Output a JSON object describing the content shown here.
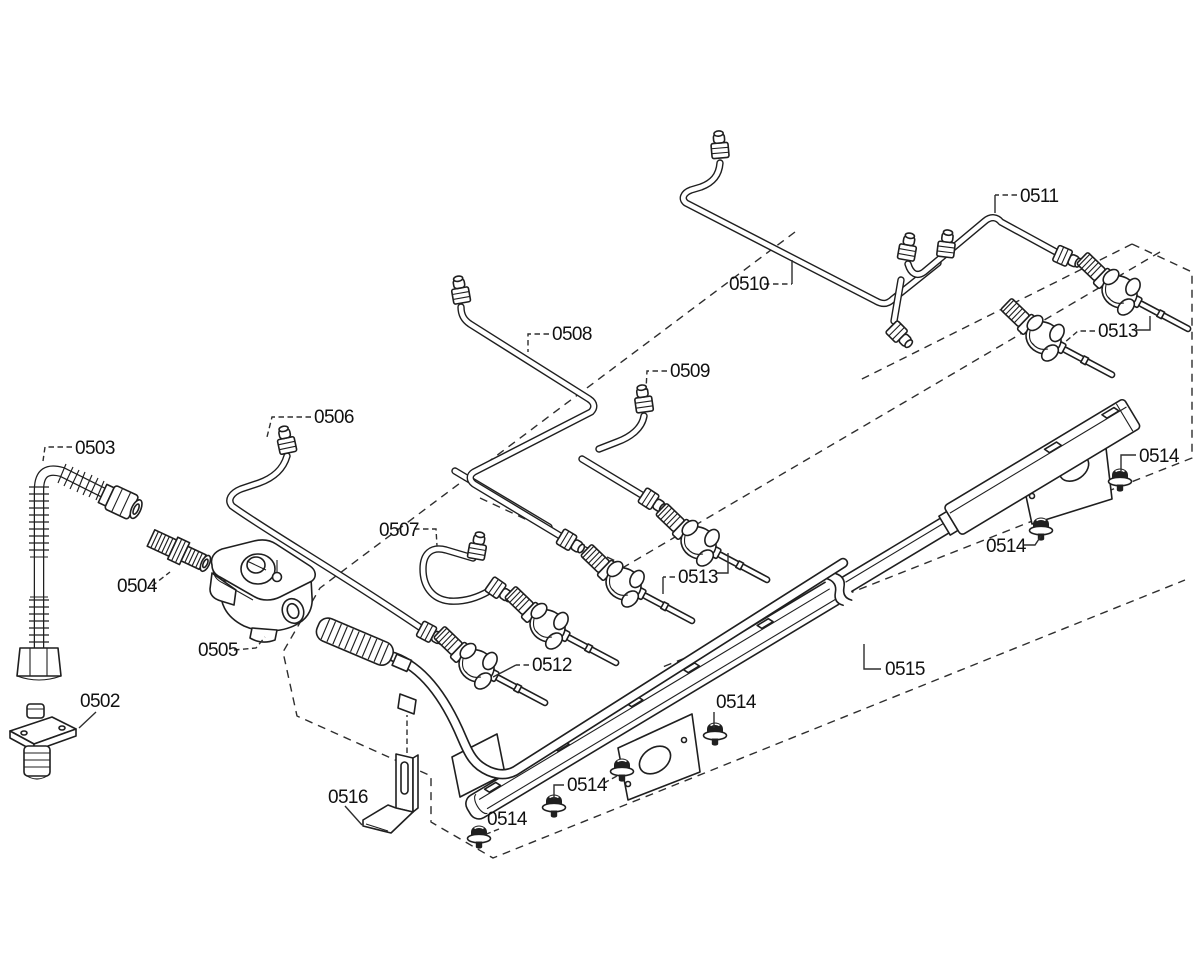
{
  "canvas": {
    "width": 1200,
    "height": 969,
    "background": "#ffffff",
    "line_color": "#1f1f1f",
    "label_color": "#111111"
  },
  "diagram": {
    "labels": [
      {
        "id": "0502",
        "text": "0502",
        "x": 80,
        "y": 707
      },
      {
        "id": "0503",
        "text": "0503",
        "x": 75,
        "y": 454
      },
      {
        "id": "0504",
        "text": "0504",
        "x": 117,
        "y": 592
      },
      {
        "id": "0505",
        "text": "0505",
        "x": 198,
        "y": 656
      },
      {
        "id": "0506",
        "text": "0506",
        "x": 314,
        "y": 423
      },
      {
        "id": "0507",
        "text": "0507",
        "x": 379,
        "y": 536
      },
      {
        "id": "0508",
        "text": "0508",
        "x": 552,
        "y": 340
      },
      {
        "id": "0509",
        "text": "0509",
        "x": 670,
        "y": 377
      },
      {
        "id": "0510",
        "text": "0510",
        "x": 729,
        "y": 290
      },
      {
        "id": "0511",
        "text": "0511",
        "x": 1020,
        "y": 202
      },
      {
        "id": "0512",
        "text": "0512",
        "x": 532,
        "y": 671
      },
      {
        "id": "0513-top",
        "text": "0513",
        "x": 1098,
        "y": 337
      },
      {
        "id": "0513-mid",
        "text": "0513",
        "x": 678,
        "y": 583
      },
      {
        "id": "0514-1",
        "text": "0514",
        "x": 1139,
        "y": 462
      },
      {
        "id": "0514-2",
        "text": "0514",
        "x": 986,
        "y": 552
      },
      {
        "id": "0514-3",
        "text": "0514",
        "x": 716,
        "y": 708
      },
      {
        "id": "0514-4",
        "text": "0514",
        "x": 567,
        "y": 791
      },
      {
        "id": "0514-5",
        "text": "0514",
        "x": 487,
        "y": 825
      },
      {
        "id": "0515",
        "text": "0515",
        "x": 885,
        "y": 675
      },
      {
        "id": "0516",
        "text": "0516",
        "x": 328,
        "y": 803
      }
    ],
    "leaders": [
      {
        "for": "0502",
        "dashed": false,
        "points": [
          [
            96,
            712
          ],
          [
            79,
            728
          ]
        ]
      },
      {
        "for": "0503",
        "dashed": true,
        "points": [
          [
            72,
            447
          ],
          [
            45,
            447
          ],
          [
            43,
            461
          ]
        ]
      },
      {
        "for": "0504",
        "dashed": true,
        "points": [
          [
            152,
            586
          ],
          [
            170,
            572
          ]
        ]
      },
      {
        "for": "0505",
        "dashed": true,
        "points": [
          [
            234,
            650
          ],
          [
            256,
            648
          ],
          [
            265,
            637
          ]
        ]
      },
      {
        "for": "0506",
        "dashed": true,
        "points": [
          [
            311,
            417
          ],
          [
            272,
            417
          ],
          [
            267,
            437
          ]
        ]
      },
      {
        "for": "0507",
        "dashed": true,
        "points": [
          [
            414,
            529
          ],
          [
            436,
            529
          ],
          [
            437,
            546
          ]
        ]
      },
      {
        "for": "0508",
        "dashed": true,
        "points": [
          [
            549,
            334
          ],
          [
            528,
            334
          ],
          [
            528,
            352
          ]
        ]
      },
      {
        "for": "0509",
        "dashed": true,
        "points": [
          [
            667,
            371
          ],
          [
            647,
            371
          ],
          [
            646,
            390
          ]
        ]
      },
      {
        "for": "0510-a",
        "dashed": true,
        "points": [
          [
            764,
            284
          ],
          [
            792,
            284
          ]
        ]
      },
      {
        "for": "0510-b",
        "dashed": false,
        "points": [
          [
            792,
            284
          ],
          [
            792,
            260
          ]
        ]
      },
      {
        "for": "0511-a",
        "dashed": true,
        "points": [
          [
            1017,
            195
          ],
          [
            995,
            195
          ]
        ]
      },
      {
        "for": "0511-b",
        "dashed": false,
        "points": [
          [
            995,
            195
          ],
          [
            995,
            213
          ]
        ]
      },
      {
        "for": "0512-a",
        "dashed": true,
        "points": [
          [
            529,
            665
          ],
          [
            516,
            665
          ]
        ]
      },
      {
        "for": "0512-b",
        "dashed": false,
        "points": [
          [
            516,
            665
          ],
          [
            493,
            677
          ]
        ]
      },
      {
        "for": "0513-top-a",
        "dashed": true,
        "points": [
          [
            1095,
            331
          ],
          [
            1078,
            331
          ],
          [
            1064,
            343
          ]
        ]
      },
      {
        "for": "0513-top-b",
        "dashed": false,
        "points": [
          [
            1136,
            330
          ],
          [
            1150,
            330
          ],
          [
            1150,
            316
          ]
        ]
      },
      {
        "for": "0513-mid-a",
        "dashed": true,
        "points": [
          [
            675,
            577
          ],
          [
            663,
            577
          ]
        ]
      },
      {
        "for": "0513-mid-b",
        "dashed": false,
        "points": [
          [
            663,
            577
          ],
          [
            663,
            594
          ]
        ]
      },
      {
        "for": "0513-mid-c",
        "dashed": false,
        "points": [
          [
            716,
            573
          ],
          [
            728,
            573
          ],
          [
            728,
            553
          ]
        ]
      },
      {
        "for": "0514-1",
        "dashed": false,
        "points": [
          [
            1136,
            455
          ],
          [
            1121,
            455
          ],
          [
            1121,
            471
          ]
        ]
      },
      {
        "for": "0514-2",
        "dashed": false,
        "points": [
          [
            1023,
            545
          ],
          [
            1035,
            545
          ],
          [
            1041,
            536
          ]
        ]
      },
      {
        "for": "0514-3",
        "dashed": false,
        "points": [
          [
            714,
            712
          ],
          [
            714,
            728
          ]
        ]
      },
      {
        "for": "0514-4a",
        "dashed": false,
        "points": [
          [
            564,
            785
          ],
          [
            554,
            785
          ],
          [
            554,
            799
          ]
        ]
      },
      {
        "for": "0514-4b",
        "dashed": true,
        "points": [
          [
            604,
            783
          ],
          [
            617,
            776
          ]
        ]
      },
      {
        "for": "0514-5",
        "dashed": true,
        "points": [
          [
            499,
            829
          ],
          [
            484,
            835
          ]
        ]
      },
      {
        "for": "0515",
        "dashed": false,
        "points": [
          [
            881,
            669
          ],
          [
            864,
            669
          ],
          [
            864,
            644
          ]
        ]
      },
      {
        "for": "0516",
        "dashed": false,
        "points": [
          [
            345,
            806
          ],
          [
            362,
            825
          ]
        ]
      },
      {
        "for": "0516-clip",
        "dashed": true,
        "points": [
          [
            407,
            753
          ],
          [
            407,
            715
          ]
        ]
      }
    ]
  }
}
